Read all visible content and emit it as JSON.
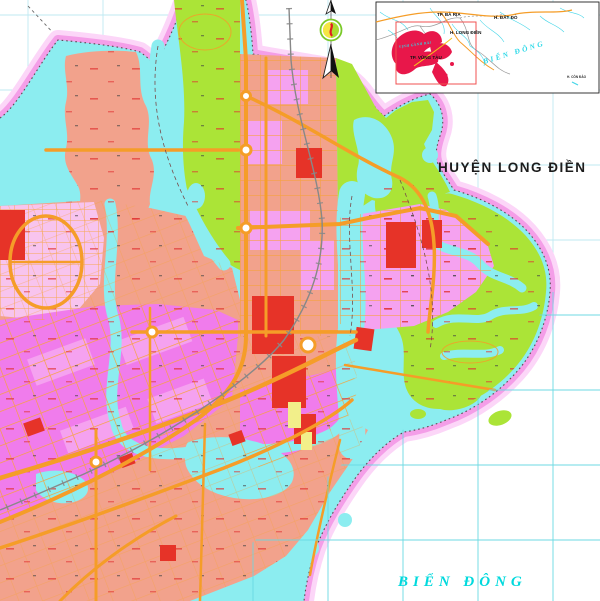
{
  "map": {
    "title": "Zoning plan map, Vũng Tàu city area",
    "labels": {
      "district": "HUYỆN LONG ĐIỀN",
      "sea": "BIỂN ĐÔNG"
    },
    "colors": {
      "background": "#ffffff",
      "grid": "#bfe9f2",
      "water": "#8cedf0",
      "boundary_band": "#f49ee8",
      "boundary_glow": "#fcd6f8",
      "boundary_dots": "#5a4a50",
      "land_salmon": "#f2a28c",
      "land_pale_pink": "#f8c4ee",
      "land_magenta": "#f07cec",
      "land_pink": "#f5a2f0",
      "green": "#abe437",
      "road_orange": "#f59d28",
      "red_parcel": "#e63328",
      "yellow_parcel": "#f2ef8a",
      "railway_grey": "#888888",
      "sea_label": "#00d9dd",
      "micro_label_red": "#e03030"
    }
  },
  "north_arrow": {
    "name": "north-arrow",
    "emblem_green": "#aadd30",
    "emblem_yellow": "#f5e642",
    "emblem_red": "#e02020"
  },
  "inset": {
    "name": "location-inset-map",
    "region_red": "#e8174a",
    "extent_outline": "#f05050",
    "labels": {
      "ba_ria": "TP. BÀ RỊA",
      "dat_do": "H. ĐẤT ĐỎ",
      "long_dien": "H. LONG ĐIỀN",
      "vung_tau": "TP. VŨNG TÀU",
      "con_dao": "H. CÔN ĐẢO",
      "sea": "BIỂN ĐÔNG",
      "bay": "VỊNH GÀNH RÁI"
    }
  }
}
